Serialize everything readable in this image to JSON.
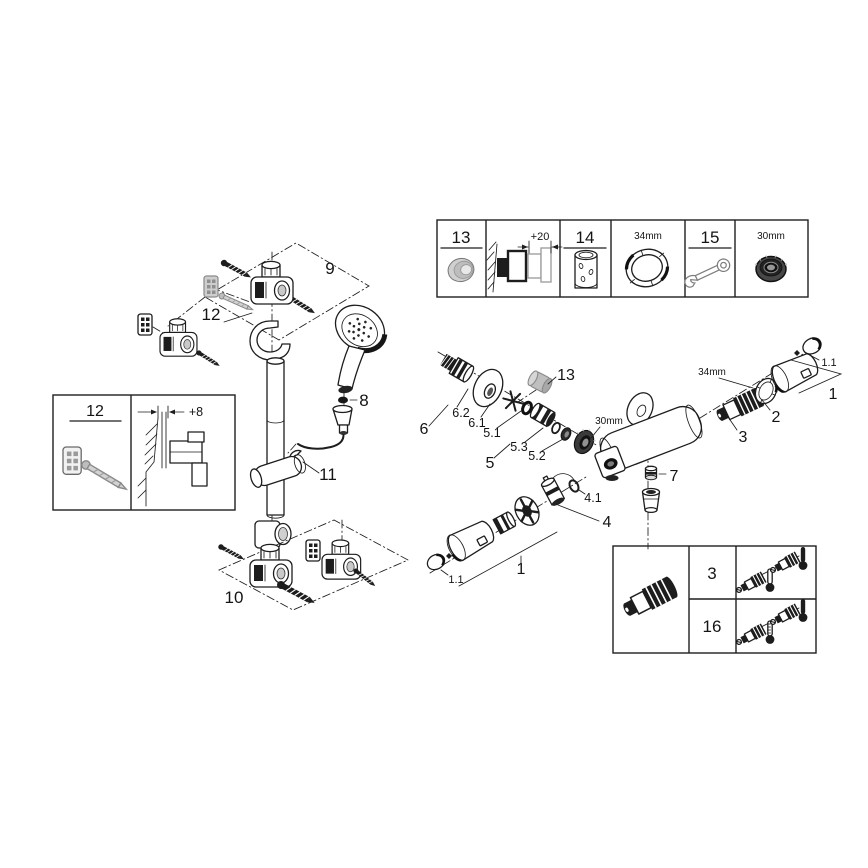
{
  "diagram_title": "Shower system exploded parts diagram",
  "top_box": {
    "cells": [
      {
        "label": "13"
      },
      {
        "dimension": "+20"
      },
      {
        "label": "14"
      },
      {
        "size": "34mm"
      },
      {
        "label": "15"
      },
      {
        "size": "30mm"
      }
    ]
  },
  "rail": {
    "labels": {
      "wall_mount_group": "9",
      "wall_plug": "12",
      "seal": "8",
      "slide_holder": "11",
      "bottom_mount_group": "10"
    }
  },
  "plug_box": {
    "part": "12",
    "offset": "+8"
  },
  "valve": {
    "labels": {
      "cap": "13",
      "union_group": "6",
      "s_union": "6.2",
      "escutcheon": "6.1",
      "seal": "5.1",
      "check_valve": "5.3",
      "bushing": "5.2",
      "check_valve_group": "5",
      "nut_size": "30mm",
      "ring_size": "34mm",
      "stop_ring": "2",
      "thermo_cartridge": "3",
      "handle": "1",
      "handle_cap": "1.1",
      "outlet_nipple": "7",
      "dimmer_seal": "4.1",
      "aquadimmer": "4",
      "handle2": "1",
      "handle2_cap": "1.1"
    }
  },
  "orientation_box": {
    "rows": [
      {
        "part": "3"
      },
      {
        "part": "16"
      }
    ]
  }
}
